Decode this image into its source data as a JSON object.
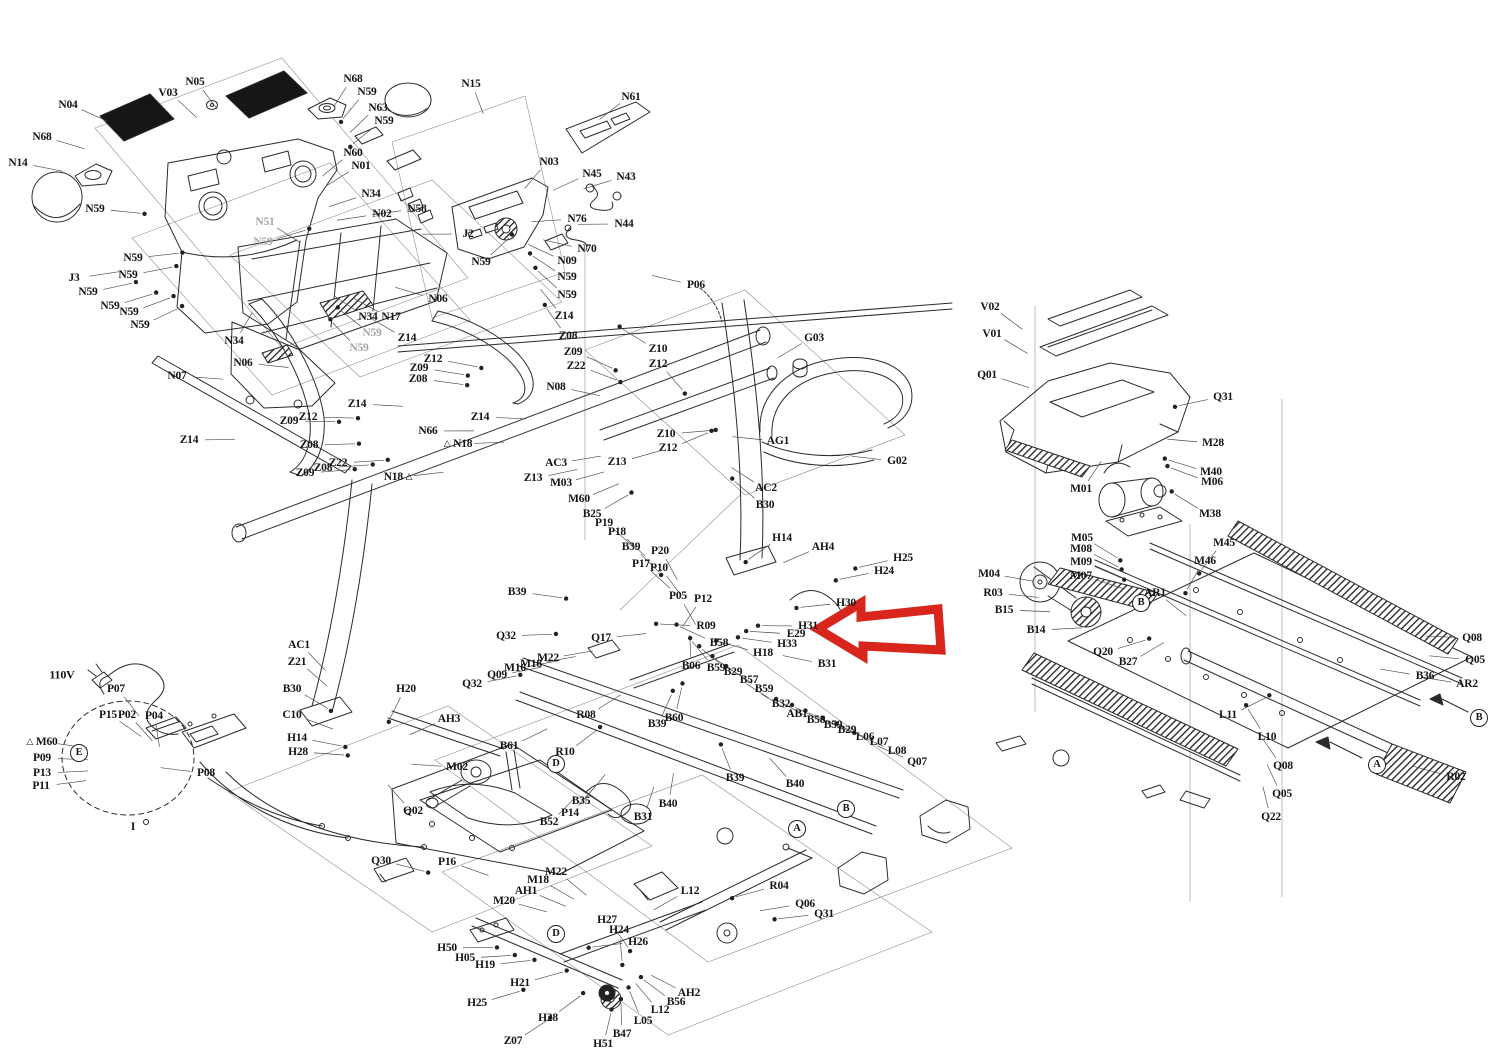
{
  "diagram": {
    "type": "exploded-parts-diagram",
    "subject": "treadmill assembly",
    "background_color": "#ffffff",
    "line_color": "#2b2b2b",
    "label_color": "#151515",
    "muted_label_color": "#a6a6a6",
    "highlight_arrow": {
      "color": "#d8261c",
      "fill": "#ffffff",
      "points_at": "H31",
      "tip_x": 818,
      "tip_y": 629,
      "tail_x": 939,
      "direction": "left"
    },
    "labels": [
      {
        "t": "N04",
        "x": 68,
        "y": 105
      },
      {
        "t": "N68",
        "x": 42,
        "y": 137
      },
      {
        "t": "N14",
        "x": 18,
        "y": 163
      },
      {
        "t": "N59",
        "x": 95,
        "y": 209
      },
      {
        "t": "V03",
        "x": 168,
        "y": 93
      },
      {
        "t": "N05",
        "x": 195,
        "y": 82
      },
      {
        "t": "N68",
        "x": 353,
        "y": 79
      },
      {
        "t": "N59",
        "x": 367,
        "y": 92
      },
      {
        "t": "N63",
        "x": 378,
        "y": 108
      },
      {
        "t": "N59",
        "x": 384,
        "y": 121
      },
      {
        "t": "N15",
        "x": 471,
        "y": 84
      },
      {
        "t": "N60",
        "x": 353,
        "y": 153
      },
      {
        "t": "N01",
        "x": 361,
        "y": 166
      },
      {
        "t": "N34",
        "x": 371,
        "y": 194
      },
      {
        "t": "N02",
        "x": 382,
        "y": 214
      },
      {
        "t": "N51",
        "x": 265,
        "y": 222,
        "s": "g"
      },
      {
        "t": "N59",
        "x": 263,
        "y": 242,
        "s": "g"
      },
      {
        "t": "J3",
        "x": 74,
        "y": 278
      },
      {
        "t": "N59",
        "x": 133,
        "y": 258
      },
      {
        "t": "N59",
        "x": 128,
        "y": 275
      },
      {
        "t": "N59",
        "x": 88,
        "y": 292
      },
      {
        "t": "N59",
        "x": 110,
        "y": 306
      },
      {
        "t": "N59",
        "x": 129,
        "y": 312
      },
      {
        "t": "N59",
        "x": 140,
        "y": 325
      },
      {
        "t": "N34",
        "x": 234,
        "y": 341
      },
      {
        "t": "N06",
        "x": 243,
        "y": 363
      },
      {
        "t": "N07",
        "x": 177,
        "y": 376
      },
      {
        "t": "Z14",
        "x": 189,
        "y": 440
      },
      {
        "t": "N34",
        "x": 368,
        "y": 317
      },
      {
        "t": "N17",
        "x": 391,
        "y": 317
      },
      {
        "t": "N59",
        "x": 372,
        "y": 333,
        "s": "g"
      },
      {
        "t": "N59",
        "x": 359,
        "y": 348,
        "s": "g"
      },
      {
        "t": "Z14",
        "x": 407,
        "y": 338
      },
      {
        "t": "Z12",
        "x": 433,
        "y": 359
      },
      {
        "t": "Z09",
        "x": 419,
        "y": 368
      },
      {
        "t": "Z08",
        "x": 418,
        "y": 379
      },
      {
        "t": "Z14",
        "x": 357,
        "y": 404
      },
      {
        "t": "Z12",
        "x": 308,
        "y": 417
      },
      {
        "t": "Z09",
        "x": 289,
        "y": 421
      },
      {
        "t": "Z08",
        "x": 309,
        "y": 445
      },
      {
        "t": "Z22",
        "x": 338,
        "y": 463
      },
      {
        "t": "Z08",
        "x": 323,
        "y": 468
      },
      {
        "t": "Z09",
        "x": 305,
        "y": 473
      },
      {
        "t": "N66",
        "x": 428,
        "y": 431
      },
      {
        "t": "N18",
        "x": 458,
        "y": 444,
        "s": "tl"
      },
      {
        "t": "N18",
        "x": 398,
        "y": 477,
        "s": "tr"
      },
      {
        "t": "N06",
        "x": 438,
        "y": 299
      },
      {
        "t": "N03",
        "x": 549,
        "y": 162
      },
      {
        "t": "N61",
        "x": 631,
        "y": 97
      },
      {
        "t": "N45",
        "x": 592,
        "y": 174
      },
      {
        "t": "N43",
        "x": 626,
        "y": 177
      },
      {
        "t": "N44",
        "x": 624,
        "y": 224
      },
      {
        "t": "N76",
        "x": 577,
        "y": 219
      },
      {
        "t": "N70",
        "x": 587,
        "y": 249
      },
      {
        "t": "J2",
        "x": 468,
        "y": 234
      },
      {
        "t": "N59",
        "x": 481,
        "y": 262
      },
      {
        "t": "N09",
        "x": 567,
        "y": 261
      },
      {
        "t": "N59",
        "x": 567,
        "y": 277
      },
      {
        "t": "N59",
        "x": 567,
        "y": 295
      },
      {
        "t": "Z14",
        "x": 564,
        "y": 316
      },
      {
        "t": "Z08",
        "x": 568,
        "y": 336
      },
      {
        "t": "Z09",
        "x": 573,
        "y": 352
      },
      {
        "t": "Z22",
        "x": 576,
        "y": 366
      },
      {
        "t": "N58",
        "x": 417,
        "y": 209
      },
      {
        "t": "N08",
        "x": 556,
        "y": 387
      },
      {
        "t": "Z14",
        "x": 480,
        "y": 417
      },
      {
        "t": "Z10",
        "x": 658,
        "y": 349
      },
      {
        "t": "Z12",
        "x": 658,
        "y": 364
      },
      {
        "t": "Z10",
        "x": 666,
        "y": 434
      },
      {
        "t": "Z12",
        "x": 668,
        "y": 448
      },
      {
        "t": "Z13",
        "x": 617,
        "y": 462
      },
      {
        "t": "Z13",
        "x": 533,
        "y": 478
      },
      {
        "t": "AC3",
        "x": 556,
        "y": 463
      },
      {
        "t": "M03",
        "x": 561,
        "y": 483
      },
      {
        "t": "M60",
        "x": 579,
        "y": 499
      },
      {
        "t": "B25",
        "x": 592,
        "y": 514
      },
      {
        "t": "P19",
        "x": 604,
        "y": 523
      },
      {
        "t": "P18",
        "x": 617,
        "y": 532
      },
      {
        "t": "B39",
        "x": 631,
        "y": 547
      },
      {
        "t": "P17",
        "x": 641,
        "y": 564
      },
      {
        "t": "P20",
        "x": 660,
        "y": 551
      },
      {
        "t": "P10",
        "x": 659,
        "y": 568
      },
      {
        "t": "P05",
        "x": 678,
        "y": 596
      },
      {
        "t": "P12",
        "x": 703,
        "y": 599
      },
      {
        "t": "P06",
        "x": 696,
        "y": 285
      },
      {
        "t": "G03",
        "x": 814,
        "y": 338
      },
      {
        "t": "G02",
        "x": 897,
        "y": 461
      },
      {
        "t": "AG1",
        "x": 778,
        "y": 441
      },
      {
        "t": "AC2",
        "x": 766,
        "y": 488
      },
      {
        "t": "B30",
        "x": 765,
        "y": 505
      },
      {
        "t": "H14",
        "x": 782,
        "y": 538
      },
      {
        "t": "AH4",
        "x": 823,
        "y": 547
      },
      {
        "t": "H25",
        "x": 903,
        "y": 558
      },
      {
        "t": "H24",
        "x": 884,
        "y": 571
      },
      {
        "t": "H30",
        "x": 846,
        "y": 603
      },
      {
        "t": "H31",
        "x": 808,
        "y": 626
      },
      {
        "t": "E29",
        "x": 796,
        "y": 634
      },
      {
        "t": "H33",
        "x": 787,
        "y": 644
      },
      {
        "t": "H18",
        "x": 763,
        "y": 653
      },
      {
        "t": "R09",
        "x": 706,
        "y": 626
      },
      {
        "t": "B58",
        "x": 719,
        "y": 643
      },
      {
        "t": "B06",
        "x": 691,
        "y": 666
      },
      {
        "t": "B59",
        "x": 716,
        "y": 668
      },
      {
        "t": "B29",
        "x": 733,
        "y": 672
      },
      {
        "t": "B57",
        "x": 749,
        "y": 680
      },
      {
        "t": "B59",
        "x": 764,
        "y": 689
      },
      {
        "t": "B31",
        "x": 827,
        "y": 664
      },
      {
        "t": "B32",
        "x": 781,
        "y": 704
      },
      {
        "t": "AB1",
        "x": 797,
        "y": 714
      },
      {
        "t": "B58",
        "x": 816,
        "y": 720
      },
      {
        "t": "B59",
        "x": 833,
        "y": 725
      },
      {
        "t": "B29",
        "x": 847,
        "y": 730
      },
      {
        "t": "L06",
        "x": 865,
        "y": 737
      },
      {
        "t": "L07",
        "x": 879,
        "y": 742
      },
      {
        "t": "L08",
        "x": 897,
        "y": 751
      },
      {
        "t": "Q07",
        "x": 917,
        "y": 762
      },
      {
        "t": "B39",
        "x": 735,
        "y": 778
      },
      {
        "t": "B40",
        "x": 795,
        "y": 784
      },
      {
        "t": "B60",
        "x": 674,
        "y": 718
      },
      {
        "t": "B39",
        "x": 657,
        "y": 724
      },
      {
        "t": "B39",
        "x": 517,
        "y": 592
      },
      {
        "t": "Q32",
        "x": 506,
        "y": 636
      },
      {
        "t": "Q17",
        "x": 601,
        "y": 638
      },
      {
        "t": "M22",
        "x": 548,
        "y": 658
      },
      {
        "t": "M18",
        "x": 531,
        "y": 664
      },
      {
        "t": "M16",
        "x": 515,
        "y": 668
      },
      {
        "t": "Q09",
        "x": 497,
        "y": 675
      },
      {
        "t": "Q32",
        "x": 472,
        "y": 684
      },
      {
        "t": "R08",
        "x": 586,
        "y": 715
      },
      {
        "t": "B61",
        "x": 509,
        "y": 746
      },
      {
        "t": "R10",
        "x": 565,
        "y": 752
      },
      {
        "t": "B35",
        "x": 581,
        "y": 801
      },
      {
        "t": "P14",
        "x": 570,
        "y": 813
      },
      {
        "t": "B52",
        "x": 549,
        "y": 822
      },
      {
        "t": "B31",
        "x": 643,
        "y": 817
      },
      {
        "t": "B40",
        "x": 668,
        "y": 804
      },
      {
        "t": "M02",
        "x": 457,
        "y": 767
      },
      {
        "t": "Q02",
        "x": 413,
        "y": 811
      },
      {
        "t": "AC1",
        "x": 299,
        "y": 645
      },
      {
        "t": "Z21",
        "x": 297,
        "y": 662
      },
      {
        "t": "B30",
        "x": 292,
        "y": 689
      },
      {
        "t": "C10",
        "x": 292,
        "y": 715
      },
      {
        "t": "H14",
        "x": 297,
        "y": 738
      },
      {
        "t": "H28",
        "x": 298,
        "y": 752
      },
      {
        "t": "H20",
        "x": 406,
        "y": 689
      },
      {
        "t": "AH3",
        "x": 449,
        "y": 719
      },
      {
        "t": "110V",
        "x": 62,
        "y": 675,
        "s": "b"
      },
      {
        "t": "P07",
        "x": 116,
        "y": 689
      },
      {
        "t": "P15",
        "x": 108,
        "y": 715
      },
      {
        "t": "P02",
        "x": 127,
        "y": 715
      },
      {
        "t": "P04",
        "x": 154,
        "y": 716
      },
      {
        "t": "M60",
        "x": 42,
        "y": 742,
        "s": "tl"
      },
      {
        "t": "P09",
        "x": 42,
        "y": 758
      },
      {
        "t": "E",
        "x": 79,
        "y": 753,
        "s": "c"
      },
      {
        "t": "P13",
        "x": 42,
        "y": 773
      },
      {
        "t": "P11",
        "x": 41,
        "y": 786
      },
      {
        "t": "P08",
        "x": 206,
        "y": 773
      },
      {
        "t": "I",
        "x": 133,
        "y": 827
      },
      {
        "t": "Q30",
        "x": 381,
        "y": 861
      },
      {
        "t": "P16",
        "x": 447,
        "y": 862
      },
      {
        "t": "M22",
        "x": 556,
        "y": 872
      },
      {
        "t": "M18",
        "x": 538,
        "y": 880
      },
      {
        "t": "AH1",
        "x": 526,
        "y": 891
      },
      {
        "t": "M20",
        "x": 504,
        "y": 901
      },
      {
        "t": "H27",
        "x": 607,
        "y": 920
      },
      {
        "t": "H24",
        "x": 619,
        "y": 930
      },
      {
        "t": "H26",
        "x": 638,
        "y": 942
      },
      {
        "t": "L12",
        "x": 690,
        "y": 891
      },
      {
        "t": "H50",
        "x": 447,
        "y": 948
      },
      {
        "t": "H05",
        "x": 465,
        "y": 958
      },
      {
        "t": "H19",
        "x": 485,
        "y": 965
      },
      {
        "t": "H21",
        "x": 520,
        "y": 983
      },
      {
        "t": "H25",
        "x": 477,
        "y": 1003
      },
      {
        "t": "H28",
        "x": 548,
        "y": 1018
      },
      {
        "t": "Z07",
        "x": 513,
        "y": 1041
      },
      {
        "t": "H51",
        "x": 603,
        "y": 1044
      },
      {
        "t": "B47",
        "x": 622,
        "y": 1034
      },
      {
        "t": "L05",
        "x": 643,
        "y": 1021
      },
      {
        "t": "L12",
        "x": 660,
        "y": 1010
      },
      {
        "t": "B56",
        "x": 676,
        "y": 1002
      },
      {
        "t": "AH2",
        "x": 689,
        "y": 993
      },
      {
        "t": "D",
        "x": 556,
        "y": 934,
        "s": "c"
      },
      {
        "t": "D",
        "x": 556,
        "y": 764,
        "s": "c"
      },
      {
        "t": "R04",
        "x": 779,
        "y": 886
      },
      {
        "t": "Q06",
        "x": 805,
        "y": 904
      },
      {
        "t": "Q31",
        "x": 824,
        "y": 914
      },
      {
        "t": "A",
        "x": 797,
        "y": 829,
        "s": "c"
      },
      {
        "t": "B",
        "x": 846,
        "y": 809,
        "s": "c"
      },
      {
        "t": "V02",
        "x": 990,
        "y": 307
      },
      {
        "t": "V01",
        "x": 992,
        "y": 334
      },
      {
        "t": "Q01",
        "x": 987,
        "y": 375
      },
      {
        "t": "Q31",
        "x": 1223,
        "y": 397
      },
      {
        "t": "M28",
        "x": 1213,
        "y": 443
      },
      {
        "t": "M40",
        "x": 1211,
        "y": 472
      },
      {
        "t": "M06",
        "x": 1212,
        "y": 482
      },
      {
        "t": "M01",
        "x": 1081,
        "y": 489
      },
      {
        "t": "M38",
        "x": 1210,
        "y": 514
      },
      {
        "t": "M45",
        "x": 1224,
        "y": 543
      },
      {
        "t": "M46",
        "x": 1205,
        "y": 561
      },
      {
        "t": "M05",
        "x": 1082,
        "y": 538
      },
      {
        "t": "M08",
        "x": 1081,
        "y": 549
      },
      {
        "t": "M09",
        "x": 1081,
        "y": 562
      },
      {
        "t": "M07",
        "x": 1081,
        "y": 576
      },
      {
        "t": "M04",
        "x": 989,
        "y": 574
      },
      {
        "t": "R03",
        "x": 993,
        "y": 593
      },
      {
        "t": "B15",
        "x": 1004,
        "y": 610
      },
      {
        "t": "B14",
        "x": 1036,
        "y": 630
      },
      {
        "t": "AR1",
        "x": 1155,
        "y": 593
      },
      {
        "t": "B",
        "x": 1141,
        "y": 603,
        "s": "c"
      },
      {
        "t": "Q20",
        "x": 1103,
        "y": 652
      },
      {
        "t": "B27",
        "x": 1128,
        "y": 662
      },
      {
        "t": "Q08",
        "x": 1472,
        "y": 638
      },
      {
        "t": "Q05",
        "x": 1475,
        "y": 660
      },
      {
        "t": "B36",
        "x": 1425,
        "y": 676
      },
      {
        "t": "AR2",
        "x": 1467,
        "y": 684
      },
      {
        "t": "L11",
        "x": 1228,
        "y": 715
      },
      {
        "t": "L10",
        "x": 1267,
        "y": 737
      },
      {
        "t": "Q08",
        "x": 1283,
        "y": 766
      },
      {
        "t": "Q05",
        "x": 1282,
        "y": 794
      },
      {
        "t": "Q22",
        "x": 1271,
        "y": 817
      },
      {
        "t": "R02",
        "x": 1456,
        "y": 777
      },
      {
        "t": "A",
        "x": 1377,
        "y": 765,
        "s": "c"
      },
      {
        "t": "B",
        "x": 1479,
        "y": 718,
        "s": "c"
      }
    ]
  }
}
